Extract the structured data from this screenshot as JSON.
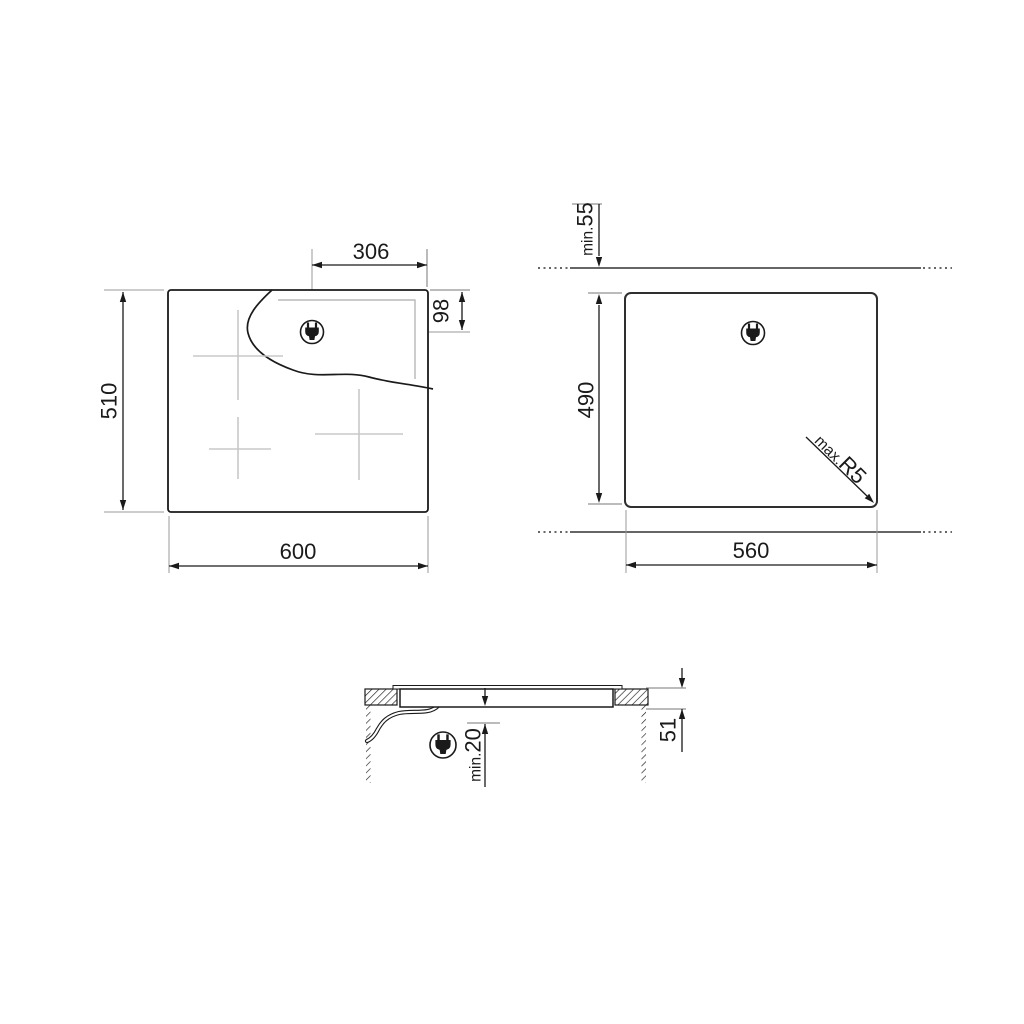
{
  "front_view": {
    "dim_width": "600",
    "dim_height": "510",
    "dim_plug_offset_horizontal": "306",
    "dim_plug_offset_vertical": "98"
  },
  "cutout_view": {
    "dim_width": "560",
    "dim_height": "490",
    "wall_clearance_prefix": "min.",
    "wall_clearance_value": "55",
    "corner_radius_prefix": "max.",
    "corner_radius_value": "R5"
  },
  "side_view": {
    "dim_built_in_height": "51",
    "clearance_prefix": "min.",
    "clearance_value": "20"
  },
  "icons": {
    "plug": "power-plug"
  },
  "colors": {
    "line": "#1a1a1a",
    "wall": "#666666",
    "extension": "#9a9a9a",
    "reveal": "#ababab",
    "burner_cross": "#c8c8c8",
    "background": "#ffffff"
  }
}
